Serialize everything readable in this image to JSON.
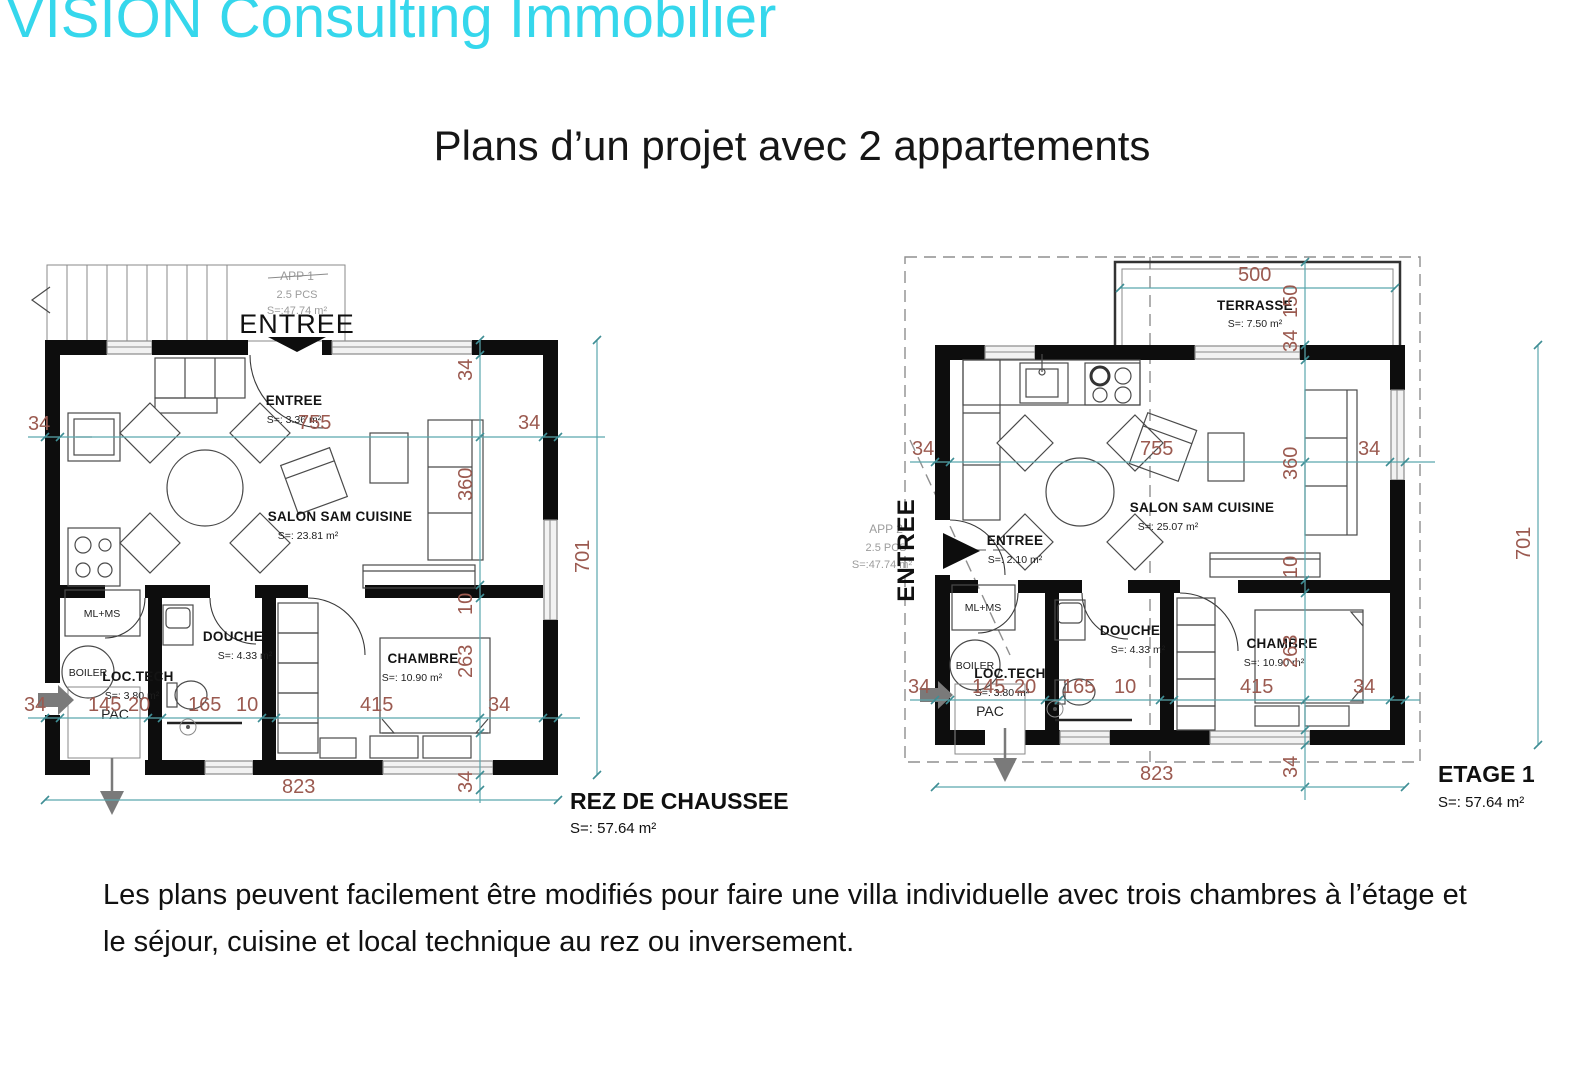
{
  "header": {
    "brand": "VISION Consulting Immobilier",
    "brand_color": "#35d7ec"
  },
  "title": "Plans d’un projet avec 2 appartements",
  "plans": {
    "ground": {
      "name": "REZ DE CHAUSSEE",
      "area": "S=: 57.64 m²",
      "apartment": {
        "id": "APP 1",
        "pcs": "2.5 PCS",
        "area": "S=:47.74 m²"
      },
      "entrance_big": "ENTREE",
      "rooms": {
        "entree": {
          "label": "ENTREE",
          "area": "S=: 3.36 m²"
        },
        "salon": {
          "label": "SALON SAM CUISINE",
          "area": "S=: 23.81 m²"
        },
        "douche": {
          "label": "DOUCHE",
          "area": "S=: 4.33 m²"
        },
        "chambre": {
          "label": "CHAMBRE",
          "area": "S=: 10.90 m²"
        },
        "loctech": {
          "label": "LOC.TECH",
          "area": "S=: 3.80 m²"
        },
        "pac": "PAC",
        "boiler": "BOILER",
        "mlms": "ML+MS"
      },
      "dims": {
        "top": [
          "34",
          "755",
          "34"
        ],
        "vert": [
          "34",
          "360",
          "10",
          "263",
          "34"
        ],
        "right": "701",
        "mid": [
          "34",
          "145",
          "20",
          "165",
          "10",
          "415",
          "34"
        ],
        "bottom": "823"
      }
    },
    "etage": {
      "name": "ETAGE 1",
      "area": "S=: 57.64 m²",
      "apartment": {
        "id": "APP 2",
        "pcs": "2.5 PCS",
        "area": "S=:47.74 m²"
      },
      "entrance_big": "ENTREE",
      "terrasse": {
        "label": "TERRASSE",
        "area": "S=: 7.50 m²"
      },
      "rooms": {
        "entree": {
          "label": "ENTREE",
          "area": "S=: 2.10 m²"
        },
        "salon": {
          "label": "SALON SAM CUISINE",
          "area": "S=: 25.07 m²"
        },
        "douche": {
          "label": "DOUCHE",
          "area": "S=: 4.33 m²"
        },
        "chambre": {
          "label": "CHAMBRE",
          "area": "S=: 10.90 m²"
        },
        "loctech": {
          "label": "LOC.TECH",
          "area": "S=: 3.80 m²"
        },
        "pac": "PAC",
        "boiler": "BOILER",
        "mlms": "ML+MS"
      },
      "dims": {
        "terrace_width": "500",
        "vert": [
          "150",
          "34",
          "360",
          "10",
          "263",
          "34"
        ],
        "top": [
          "34",
          "755",
          "34"
        ],
        "right": "701",
        "mid": [
          "34",
          "145",
          "20",
          "165",
          "10",
          "415",
          "34"
        ],
        "bottom": "823"
      }
    }
  },
  "footer": {
    "line1": "Les plans peuvent facilement être modifiés pour faire une villa individuelle avec trois chambres à l’étage et",
    "line2": "le séjour, cuisine et local technique au rez ou inversement."
  },
  "colors": {
    "dimension_text": "#9b5a50",
    "dimension_line": "#5aa7ad",
    "wall": "#0d0d0d"
  }
}
